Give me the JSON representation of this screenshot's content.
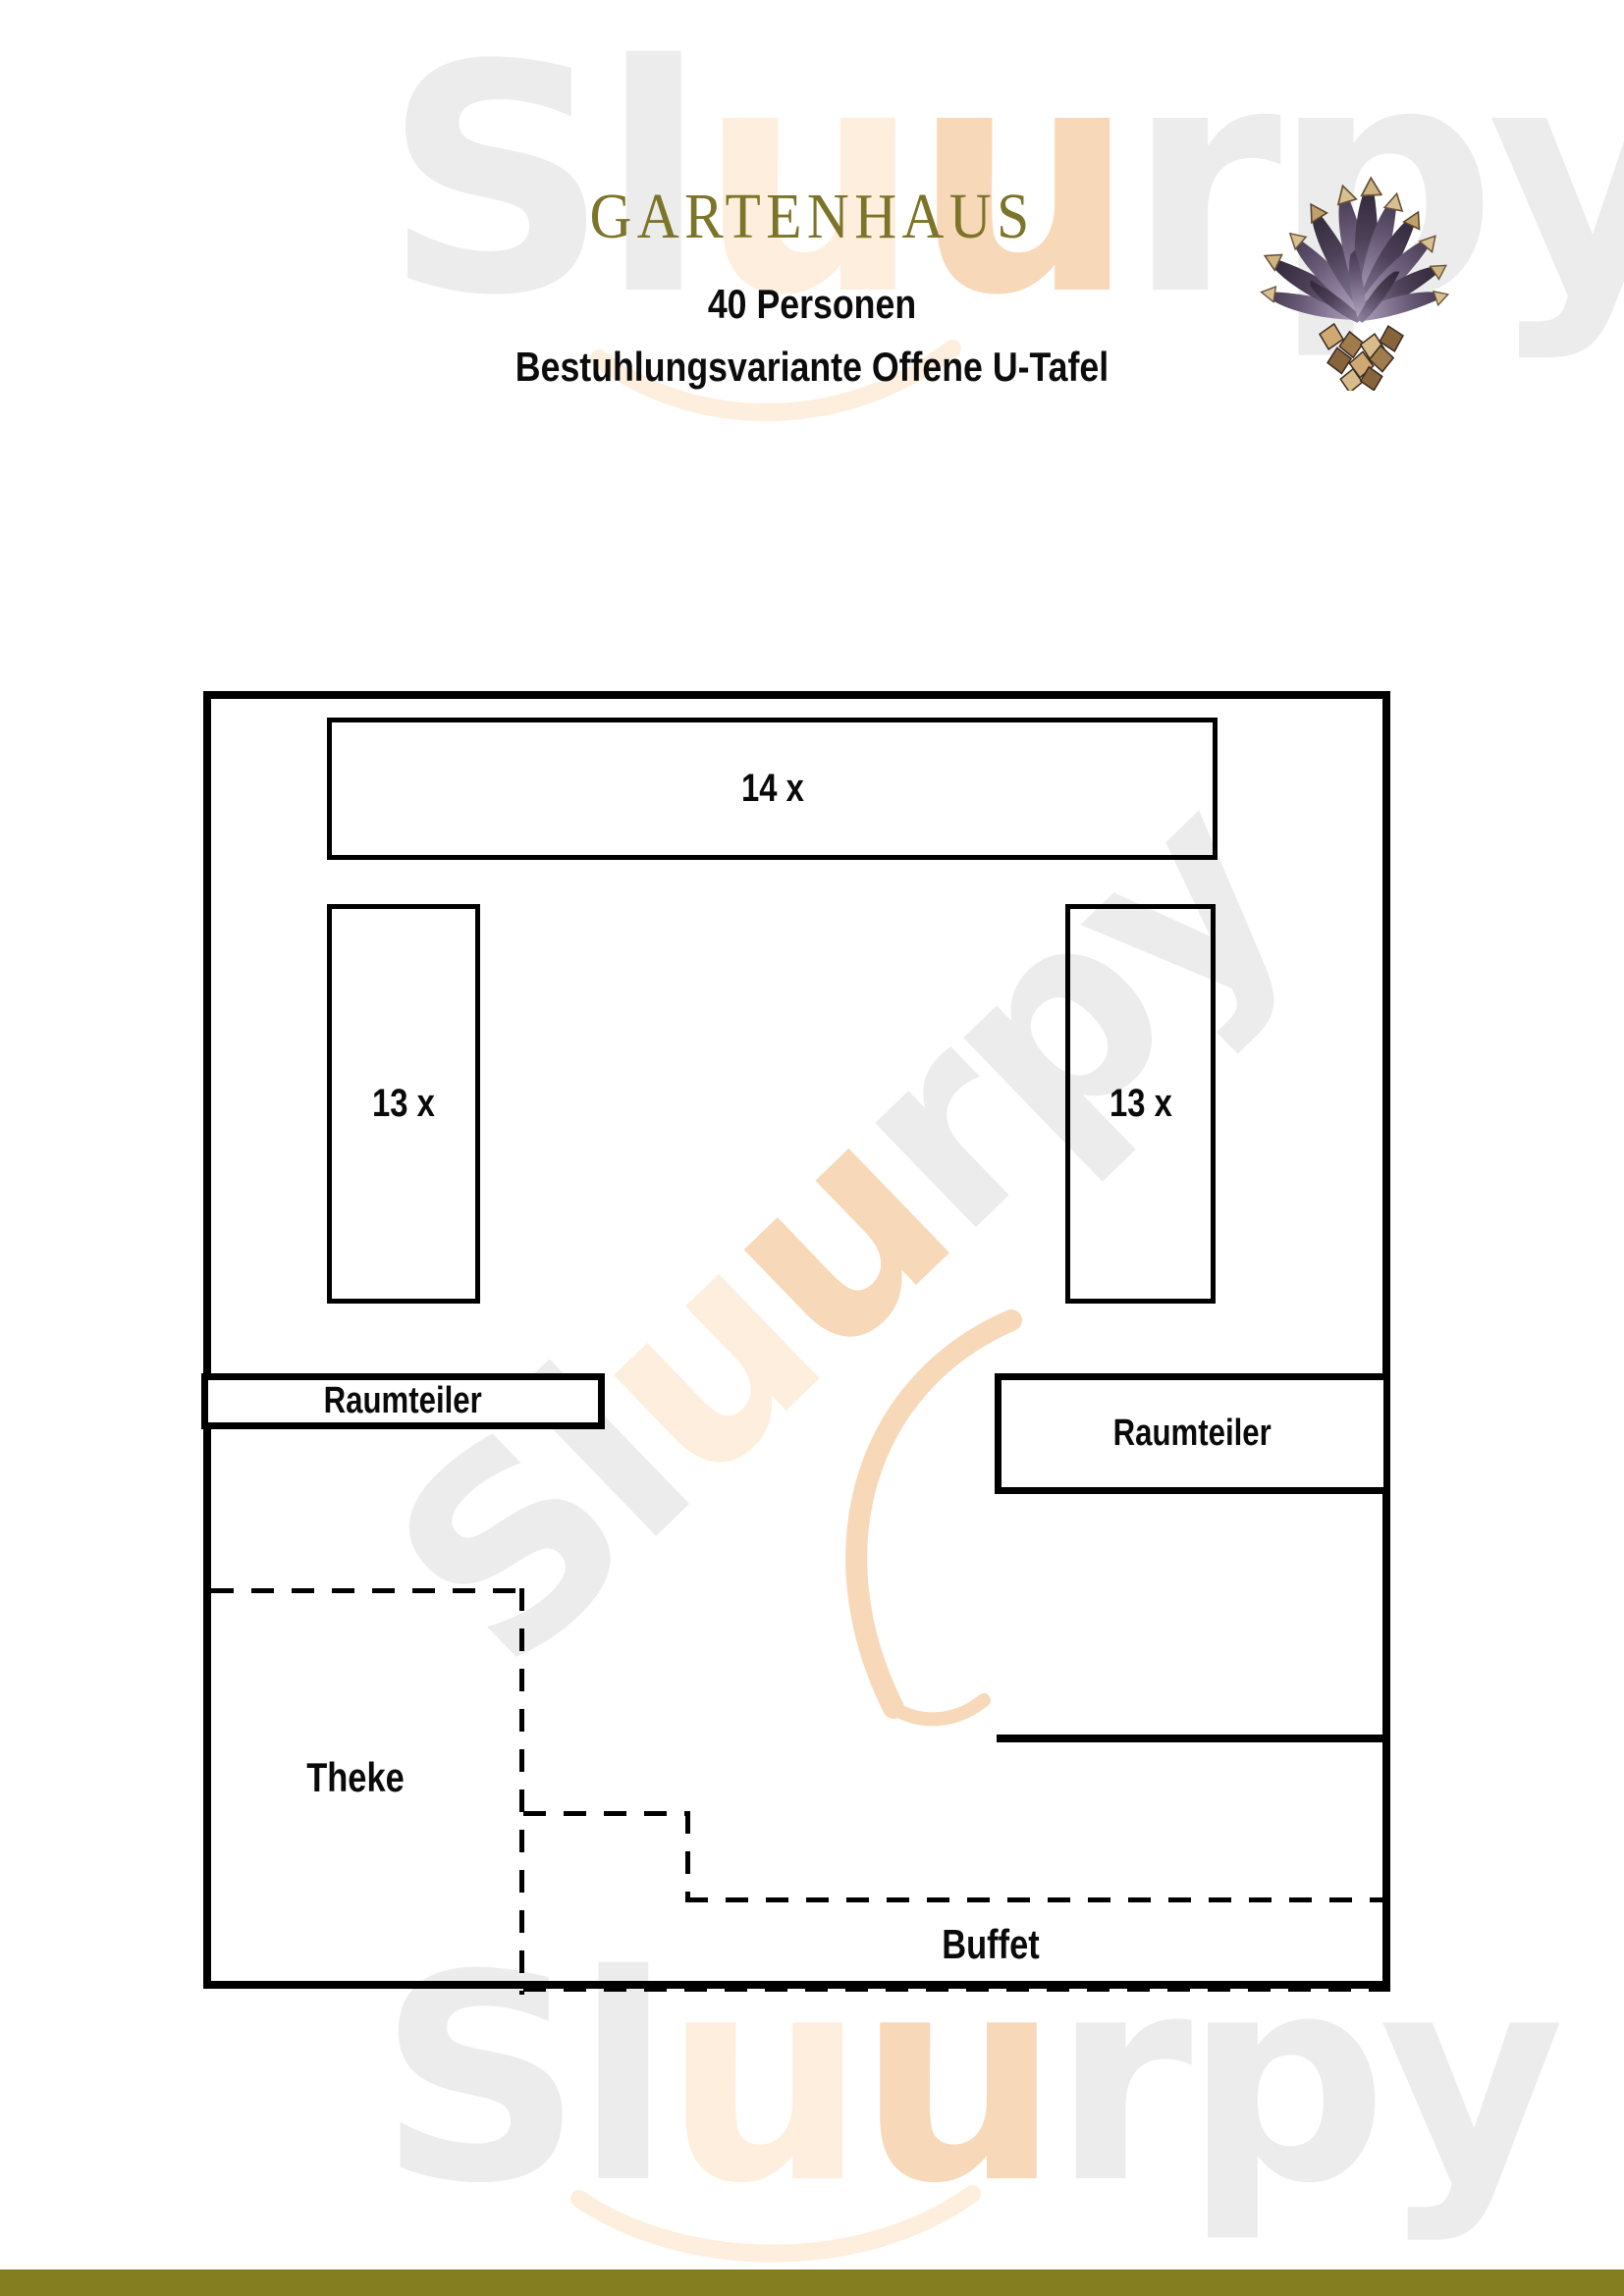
{
  "header": {
    "title": "GARTENHAUS",
    "capacity": "40 Personen",
    "variant": "Bestuhlungsvariante Offene U-Tafel"
  },
  "floor_plan": {
    "tables": [
      {
        "id": "head-table",
        "label": "14 x"
      },
      {
        "id": "left-table",
        "label": "13 x"
      },
      {
        "id": "right-table",
        "label": "13 x"
      }
    ],
    "dividers": [
      {
        "label": "Raumteiler"
      },
      {
        "label": "Raumteiler"
      }
    ],
    "counter_label": "Theke",
    "buffet_label": "Buffet"
  },
  "watermark": {
    "segments": [
      {
        "text": "Sl"
      },
      {
        "text": "u"
      },
      {
        "text": "u"
      },
      {
        "text": "rpy"
      }
    ]
  },
  "colors": {
    "title_olive": "#7c7428",
    "footer_bar": "#847e20",
    "plan_line": "#000000",
    "watermark_gray": "#ececec",
    "watermark_orange_light": "#fdeedd",
    "watermark_orange_deep": "#f7d8b8"
  }
}
